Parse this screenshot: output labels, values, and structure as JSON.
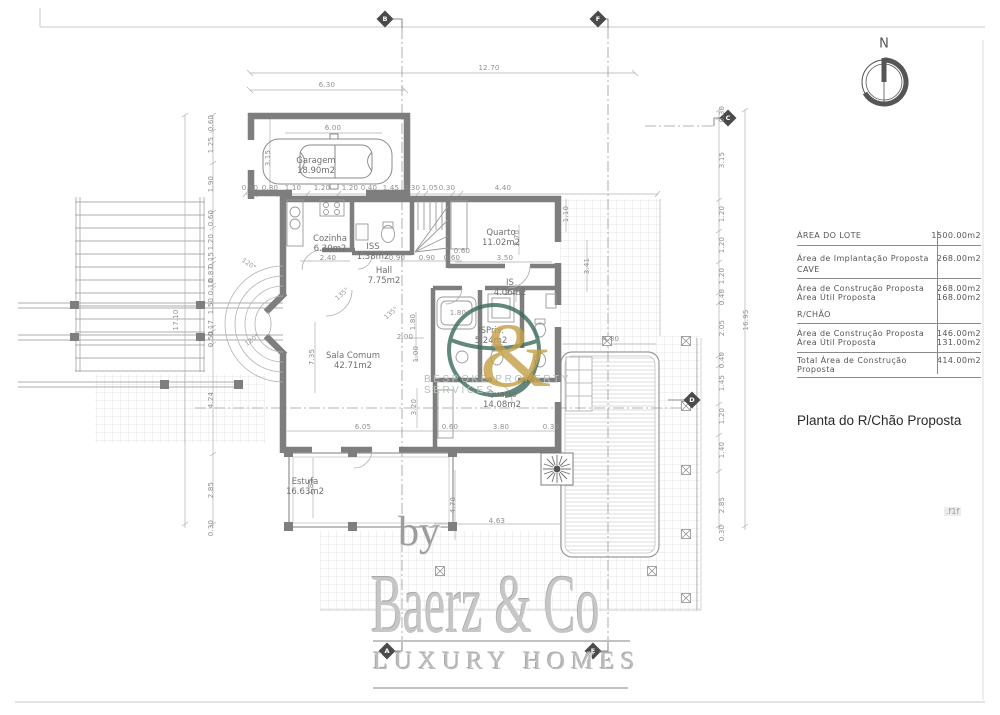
{
  "colors": {
    "wall": "#7e7e7e",
    "line": "#9a9a9a",
    "logo_green": "#3c6a5b",
    "logo_gold": "#c6a048"
  },
  "north_label": "N",
  "edge_tag": ".f1f",
  "drawing_title": "Planta do R/Chão Proposta",
  "table": {
    "rows": [
      {
        "label": "ÁREA  DO  LOTE",
        "value": "1500.00m2"
      },
      {
        "label": "Área  de  Implantação  Proposta",
        "value": "268.00m2"
      },
      {
        "section": "CAVE"
      },
      {
        "label": "Área  de  Construção  Proposta",
        "value": "268.00m2"
      },
      {
        "label": "Área  Útil  Proposta",
        "value": "168.00m2"
      },
      {
        "section": "R/CHÃO"
      },
      {
        "label": "Área  de  Construção  Proposta",
        "value": "146.00m2"
      },
      {
        "label": "Área  Útil  Proposta",
        "value": "131.00m2"
      },
      {
        "label": "Total  Área  de  Construção  Proposta",
        "value": "414.00m2"
      }
    ]
  },
  "watermark": {
    "by": "by",
    "brand": "Baerz & Co",
    "tagline": "LUXURY HOMES",
    "services": "BESPOKE PROPERTY SERVICES",
    "ampersand": "&"
  },
  "plan": {
    "rooms": [
      {
        "name": "Garagem",
        "area": "18.90m2",
        "x": 316,
        "y": 166
      },
      {
        "name": "Cozinha",
        "area": "6.30m2",
        "x": 330,
        "y": 244
      },
      {
        "name": "ISS",
        "area": "1.38m2",
        "x": 373,
        "y": 252
      },
      {
        "name": "Hall",
        "area": "7.75m2",
        "x": 384,
        "y": 276
      },
      {
        "name": "Quarto",
        "area": "11.02m2",
        "x": 501,
        "y": 238
      },
      {
        "name": "IS",
        "area": "4.06m2",
        "x": 510,
        "y": 288
      },
      {
        "name": "ISPriv.",
        "area": "5.24m2",
        "x": 491,
        "y": 336
      },
      {
        "name": "Sala Comum",
        "area": "42.71m2",
        "x": 353,
        "y": 361
      },
      {
        "name": "Quarto",
        "area": "14.08m2",
        "x": 502,
        "y": 400
      },
      {
        "name": "Estufa",
        "area": "16.63m2",
        "x": 305,
        "y": 487
      }
    ],
    "markers": [
      {
        "t": "B",
        "x": 385,
        "y": 19
      },
      {
        "t": "F",
        "x": 598,
        "y": 19
      },
      {
        "t": "C",
        "x": 728,
        "y": 118
      },
      {
        "t": "D",
        "x": 692,
        "y": 400
      },
      {
        "t": "A",
        "x": 387,
        "y": 651
      },
      {
        "t": "E",
        "x": 593,
        "y": 651
      }
    ],
    "dims": [
      {
        "t": "12.70",
        "x": 489,
        "y": 68
      },
      {
        "t": "6.30",
        "x": 327,
        "y": 85
      },
      {
        "t": "6.00",
        "x": 333,
        "y": 128
      },
      {
        "t": "3.15",
        "x": 268,
        "y": 158,
        "v": 1
      },
      {
        "t": "0.50",
        "x": 250,
        "y": 188
      },
      {
        "t": "0.80",
        "x": 270,
        "y": 188
      },
      {
        "t": "1.10",
        "x": 293,
        "y": 188
      },
      {
        "t": "1.20",
        "x": 322,
        "y": 188
      },
      {
        "t": "1.20",
        "x": 350,
        "y": 188
      },
      {
        "t": "0.40",
        "x": 369,
        "y": 188
      },
      {
        "t": "1.45",
        "x": 391,
        "y": 188
      },
      {
        "t": "0.30",
        "x": 412,
        "y": 188
      },
      {
        "t": "1.05",
        "x": 430,
        "y": 188
      },
      {
        "t": "0.30",
        "x": 447,
        "y": 188
      },
      {
        "t": "4.40",
        "x": 503,
        "y": 188
      },
      {
        "t": "17.10",
        "x": 176,
        "y": 320,
        "v": 1
      },
      {
        "t": "0.60",
        "x": 211,
        "y": 123,
        "v": 1
      },
      {
        "t": "1.25",
        "x": 211,
        "y": 145,
        "v": 1
      },
      {
        "t": "1.90",
        "x": 211,
        "y": 184,
        "v": 1
      },
      {
        "t": "0.60",
        "x": 211,
        "y": 218,
        "v": 1
      },
      {
        "t": "1.20",
        "x": 211,
        "y": 242,
        "v": 1
      },
      {
        "t": "0.15",
        "x": 211,
        "y": 260,
        "v": 1
      },
      {
        "t": "0.87",
        "x": 211,
        "y": 274,
        "v": 1
      },
      {
        "t": "0.10",
        "x": 211,
        "y": 287,
        "v": 1
      },
      {
        "t": "1.50",
        "x": 211,
        "y": 306,
        "v": 1
      },
      {
        "t": "0.17",
        "x": 211,
        "y": 328,
        "v": 1
      },
      {
        "t": "0.50",
        "x": 211,
        "y": 339,
        "v": 1
      },
      {
        "t": "4.24",
        "x": 211,
        "y": 400,
        "v": 1
      },
      {
        "t": "2.85",
        "x": 211,
        "y": 490,
        "v": 1
      },
      {
        "t": "0.30",
        "x": 211,
        "y": 528,
        "v": 1
      },
      {
        "t": "16.95",
        "x": 746,
        "y": 320,
        "v": 1
      },
      {
        "t": "0.30",
        "x": 722,
        "y": 114,
        "v": 1
      },
      {
        "t": "3.15",
        "x": 722,
        "y": 160,
        "v": 1
      },
      {
        "t": "1.20",
        "x": 722,
        "y": 214,
        "v": 1
      },
      {
        "t": "1.20",
        "x": 722,
        "y": 245,
        "v": 1
      },
      {
        "t": "1.20",
        "x": 722,
        "y": 276,
        "v": 1
      },
      {
        "t": "0.40",
        "x": 722,
        "y": 297,
        "v": 1
      },
      {
        "t": "2.05",
        "x": 722,
        "y": 328,
        "v": 1
      },
      {
        "t": "0.40",
        "x": 722,
        "y": 360,
        "v": 1
      },
      {
        "t": "1.45",
        "x": 722,
        "y": 383,
        "v": 1
      },
      {
        "t": "1.20",
        "x": 722,
        "y": 416,
        "v": 1
      },
      {
        "t": "1.40",
        "x": 722,
        "y": 450,
        "v": 1
      },
      {
        "t": "2.85",
        "x": 722,
        "y": 505,
        "v": 1
      },
      {
        "t": "0.30",
        "x": 722,
        "y": 533,
        "v": 1
      },
      {
        "t": "2.40",
        "x": 328,
        "y": 258
      },
      {
        "t": "0.90",
        "x": 397,
        "y": 258
      },
      {
        "t": "0.90",
        "x": 427,
        "y": 258
      },
      {
        "t": "0.60",
        "x": 452,
        "y": 258
      },
      {
        "t": "3.50",
        "x": 505,
        "y": 258
      },
      {
        "t": "0.60",
        "x": 462,
        "y": 251
      },
      {
        "t": "2.70",
        "x": 517,
        "y": 238,
        "v": 1
      },
      {
        "t": "1.10",
        "x": 566,
        "y": 214,
        "v": 1
      },
      {
        "t": "3.41",
        "x": 587,
        "y": 266,
        "v": 1
      },
      {
        "t": "1.80",
        "x": 458,
        "y": 313
      },
      {
        "t": "2.45",
        "x": 513,
        "y": 293
      },
      {
        "t": "1.80",
        "x": 413,
        "y": 322,
        "v": 1
      },
      {
        "t": "2.00",
        "x": 405,
        "y": 337
      },
      {
        "t": "1.00",
        "x": 416,
        "y": 354,
        "v": 1
      },
      {
        "t": "3.20",
        "x": 414,
        "y": 407,
        "v": 1
      },
      {
        "t": "7.35",
        "x": 312,
        "y": 357,
        "v": 1
      },
      {
        "t": "6.05",
        "x": 363,
        "y": 427
      },
      {
        "t": "0.60",
        "x": 450,
        "y": 427
      },
      {
        "t": "3.80",
        "x": 501,
        "y": 427
      },
      {
        "t": "0.30",
        "x": 551,
        "y": 427
      },
      {
        "t": "2.85",
        "x": 311,
        "y": 487,
        "v": 1
      },
      {
        "t": "4.70",
        "x": 453,
        "y": 505,
        "v": 1
      },
      {
        "t": "4.63",
        "x": 497,
        "y": 521
      },
      {
        "t": "4.80",
        "x": 611,
        "y": 339
      }
    ],
    "angles": [
      {
        "t": "135°",
        "x": 342,
        "y": 294,
        "r": -40
      },
      {
        "t": "135°",
        "x": 391,
        "y": 313,
        "r": -40
      },
      {
        "t": "120°",
        "x": 249,
        "y": 264,
        "r": 35
      },
      {
        "t": "120°",
        "x": 252,
        "y": 340,
        "r": -35
      }
    ]
  }
}
